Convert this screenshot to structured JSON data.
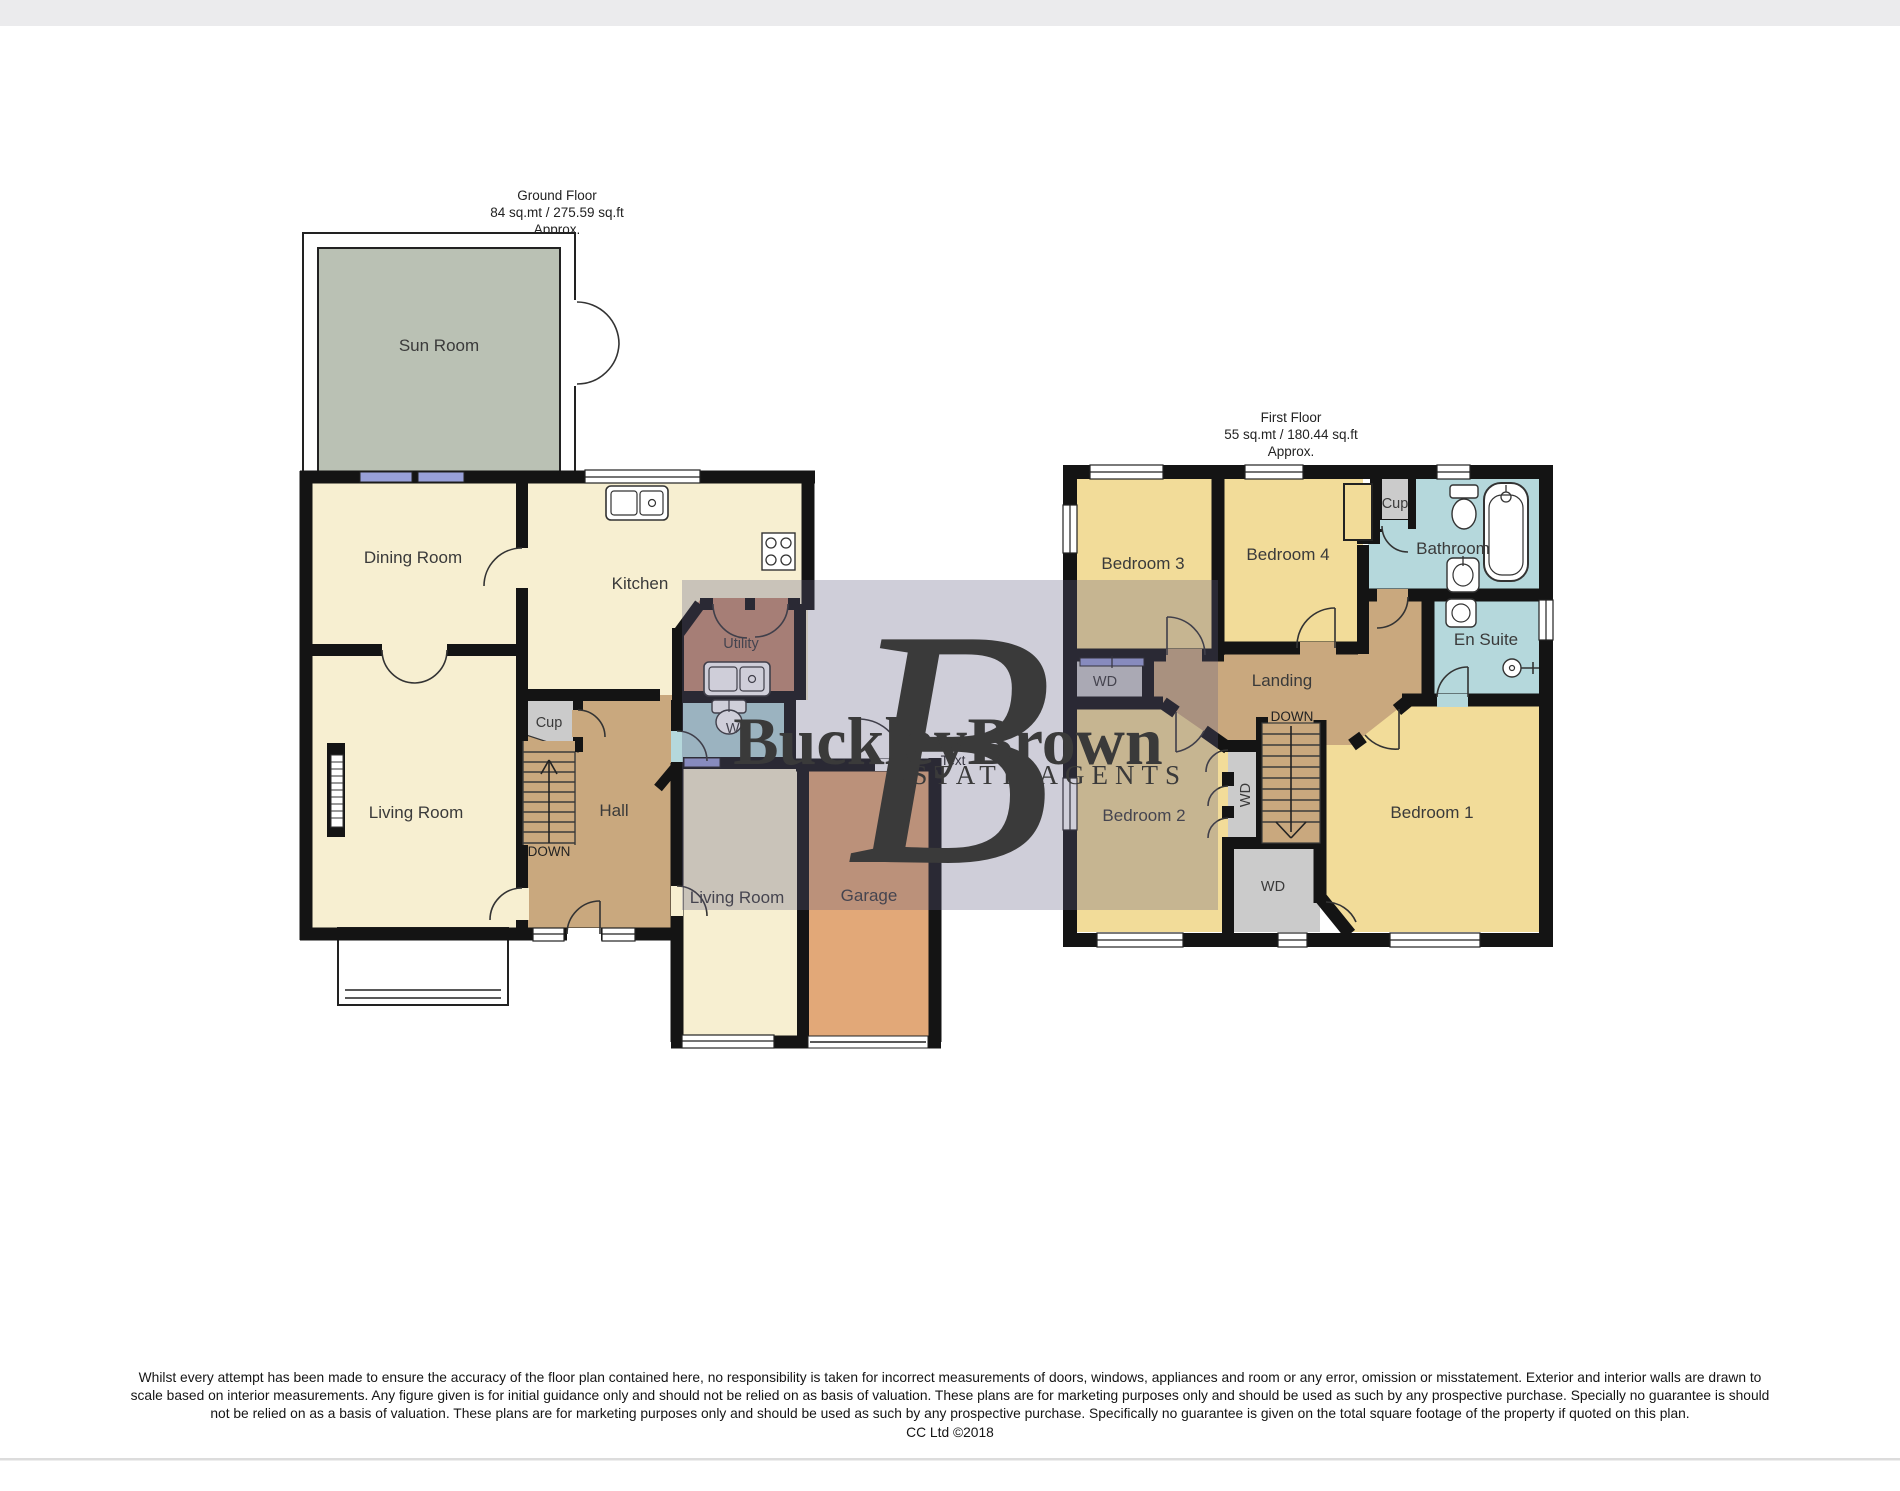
{
  "ground_floor": {
    "title": {
      "line1": "Ground Floor",
      "line2": "84 sq.mt / 275.59 sq.ft",
      "line3": "Approx."
    },
    "rooms": {
      "sun_room": "Sun Room",
      "dining_room": "Dining Room",
      "kitchen": "Kitchen",
      "living_room": "Living Room",
      "hall": "Hall",
      "cupboard": "Cup",
      "utility": "Utility",
      "wc": "WC",
      "stairs_label": "DOWN",
      "living_room_2": "Living Room",
      "garage": "Garage"
    },
    "stray_label": "Text"
  },
  "first_floor": {
    "title": {
      "line1": "First Floor",
      "line2": "55 sq.mt / 180.44 sq.ft",
      "line3": "Approx."
    },
    "rooms": {
      "bedroom_1": "Bedroom 1",
      "bedroom_2": "Bedroom 2",
      "bedroom_3": "Bedroom 3",
      "bedroom_4": "Bedroom 4",
      "bathroom": "Bathroom",
      "en_suite": "En Suite",
      "landing": "Landing",
      "cupboard": "Cup",
      "wardrobe_closet": "WD",
      "wardrobe_strip": "WD",
      "wardrobe_room": "WD",
      "stairs_label": "DOWN"
    }
  },
  "watermark": {
    "monogram": "B",
    "brand": "BuckleyBrown",
    "tagline": "ESTATE AGENTS"
  },
  "colors": {
    "cream": "#f7efd1",
    "yellow": "#f2dc99",
    "tan": "#c9a87e",
    "salmon": "#c48d72",
    "orange": "#e2a878",
    "grey_closet": "#cbcbcb",
    "blue_bath": "#b5d8dc",
    "green_sunroom": "#bac1b4",
    "wall": "#141414",
    "window_blue": "#98a0d8"
  },
  "disclaimer": {
    "line1": "Whilst every attempt has been made to ensure the accuracy of the floor plan contained here, no responsibility is taken for incorrect measurements of doors, windows, appliances and room or any error, omission or misstatement. Exterior and interior walls are drawn to",
    "line2": "scale based on interior measurements. Any figure given is for initial guidance only and should not be relied on as basis of valuation. These plans are for marketing purposes only and should be used as such by any prospective purchase. Specially no guarantee is should",
    "line3": "not be relied on as a basis of valuation. These plans are for marketing purposes only and should be used as such by any prospective purchase. Specifically no guarantee is given on the total square footage of the property if quoted on this plan.",
    "credit": "CC Ltd ©2018"
  }
}
